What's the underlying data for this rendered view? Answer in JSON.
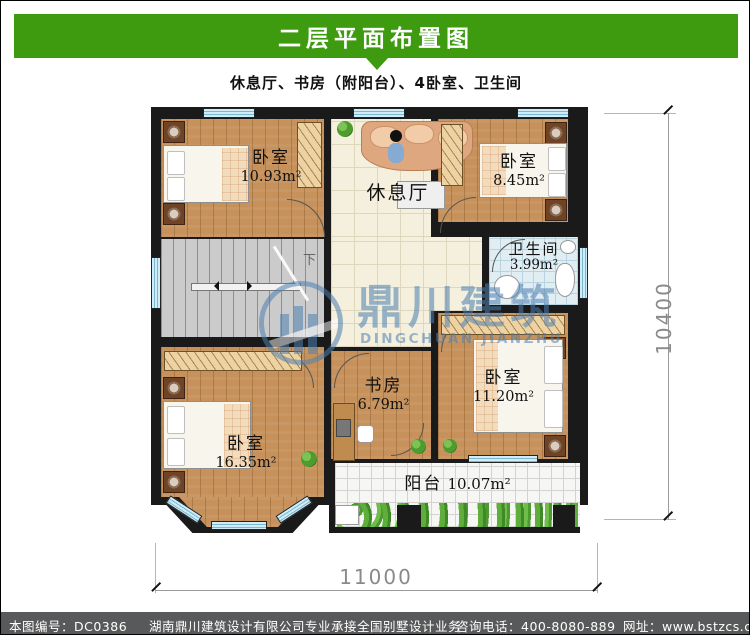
{
  "page": {
    "title": "二层平面布置图",
    "subtitle": "休息厅、书房（附阳台）、4卧室、卫生间"
  },
  "rooms": {
    "bedroom_tl": {
      "name": "卧室",
      "area": "10.93m²"
    },
    "bedroom_tr": {
      "name": "卧室",
      "area": "8.45m²"
    },
    "hall": {
      "name": "休息厅"
    },
    "bathroom": {
      "name": "卫生间",
      "area": "3.99m²"
    },
    "study": {
      "name": "书房",
      "area": "6.79m²"
    },
    "bedroom_br": {
      "name": "卧室",
      "area": "11.20m²"
    },
    "bedroom_bl": {
      "name": "卧室",
      "area": "16.35m²"
    },
    "balcony": {
      "name": "阳台",
      "area": "10.07m²"
    },
    "stairs_down_label": "下"
  },
  "dimensions": {
    "width_mm": "11000",
    "height_mm": "10400"
  },
  "watermark": {
    "cn": "鼎川建筑",
    "en": "DINGCHUAN JIANZHU"
  },
  "footer": {
    "drawing_no": "本图编号：DC0386",
    "company": "湖南鼎川建筑设计有限公司专业承接全国别墅设计业务",
    "phone": "咨询电话：400-8080-889",
    "website": "网址：www.bstzcs.com"
  },
  "colors": {
    "banner_green": "#3E9B10",
    "footer_gray": "#58595B",
    "wall_black": "#1A1A1A",
    "watermark_blue": "#4C7FB0",
    "wood_floor": "#C6915A",
    "window_blue": "#CFEDF8"
  }
}
